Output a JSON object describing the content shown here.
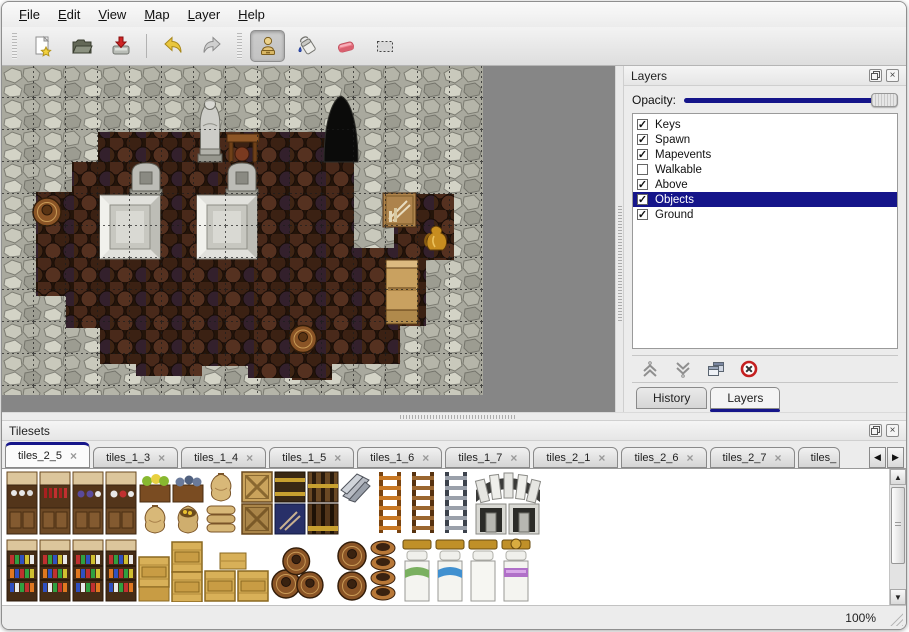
{
  "window": {
    "status_zoom": "100%"
  },
  "menu_bar": {
    "items": [
      {
        "label": "File"
      },
      {
        "label": "Edit"
      },
      {
        "label": "View"
      },
      {
        "label": "Map"
      },
      {
        "label": "Layer"
      },
      {
        "label": "Help"
      }
    ]
  },
  "toolbar": {
    "buttons": [
      {
        "name": "new-file",
        "active": false
      },
      {
        "name": "open-file",
        "active": false
      },
      {
        "name": "save-file",
        "active": false
      },
      {
        "name": "undo",
        "active": false
      },
      {
        "name": "redo",
        "active": false
      },
      {
        "name": "stamp-tool",
        "active": true
      },
      {
        "name": "fill-tool",
        "active": false
      },
      {
        "name": "eraser-tool",
        "active": false
      },
      {
        "name": "select-tool",
        "active": false
      }
    ]
  },
  "layers_panel": {
    "title": "Layers",
    "opacity_label": "Opacity:",
    "opacity_percent": 100,
    "layers": [
      {
        "label": "Keys",
        "checked": true,
        "selected": false
      },
      {
        "label": "Spawn",
        "checked": true,
        "selected": false
      },
      {
        "label": "Mapevents",
        "checked": true,
        "selected": false
      },
      {
        "label": "Walkable",
        "checked": false,
        "selected": false
      },
      {
        "label": "Above",
        "checked": true,
        "selected": false
      },
      {
        "label": "Objects",
        "checked": true,
        "selected": true
      },
      {
        "label": "Ground",
        "checked": true,
        "selected": false
      }
    ],
    "action_buttons": [
      {
        "name": "move-layer-up"
      },
      {
        "name": "move-layer-down"
      },
      {
        "name": "duplicate-layer"
      },
      {
        "name": "delete-layer"
      }
    ],
    "dock_tabs": [
      {
        "label": "History",
        "active": false
      },
      {
        "label": "Layers",
        "active": true
      }
    ]
  },
  "tilesets_panel": {
    "title": "Tilesets",
    "tabs": [
      {
        "label": "tiles_2_5",
        "active": true,
        "partial": false
      },
      {
        "label": "tiles_1_3",
        "active": false,
        "partial": false
      },
      {
        "label": "tiles_1_4",
        "active": false,
        "partial": false
      },
      {
        "label": "tiles_1_5",
        "active": false,
        "partial": false
      },
      {
        "label": "tiles_1_6",
        "active": false,
        "partial": false
      },
      {
        "label": "tiles_1_7",
        "active": false,
        "partial": false
      },
      {
        "label": "tiles_2_1",
        "active": false,
        "partial": false
      },
      {
        "label": "tiles_2_6",
        "active": false,
        "partial": false
      },
      {
        "label": "tiles_2_7",
        "active": false,
        "partial": false
      },
      {
        "label": "tiles_",
        "active": false,
        "partial": true
      }
    ]
  },
  "icons": {
    "close_x": "×",
    "check": "✓",
    "arrow_left": "◀",
    "arrow_right": "▶",
    "arrow_up": "▲",
    "arrow_down": "▼"
  },
  "colors": {
    "selection_navy": "#15158a",
    "opacity_groove": "#15158a",
    "eraser_pink": "#ee7f8d",
    "undo_yellow": "#e9c63d",
    "delete_red": "#c42020"
  }
}
